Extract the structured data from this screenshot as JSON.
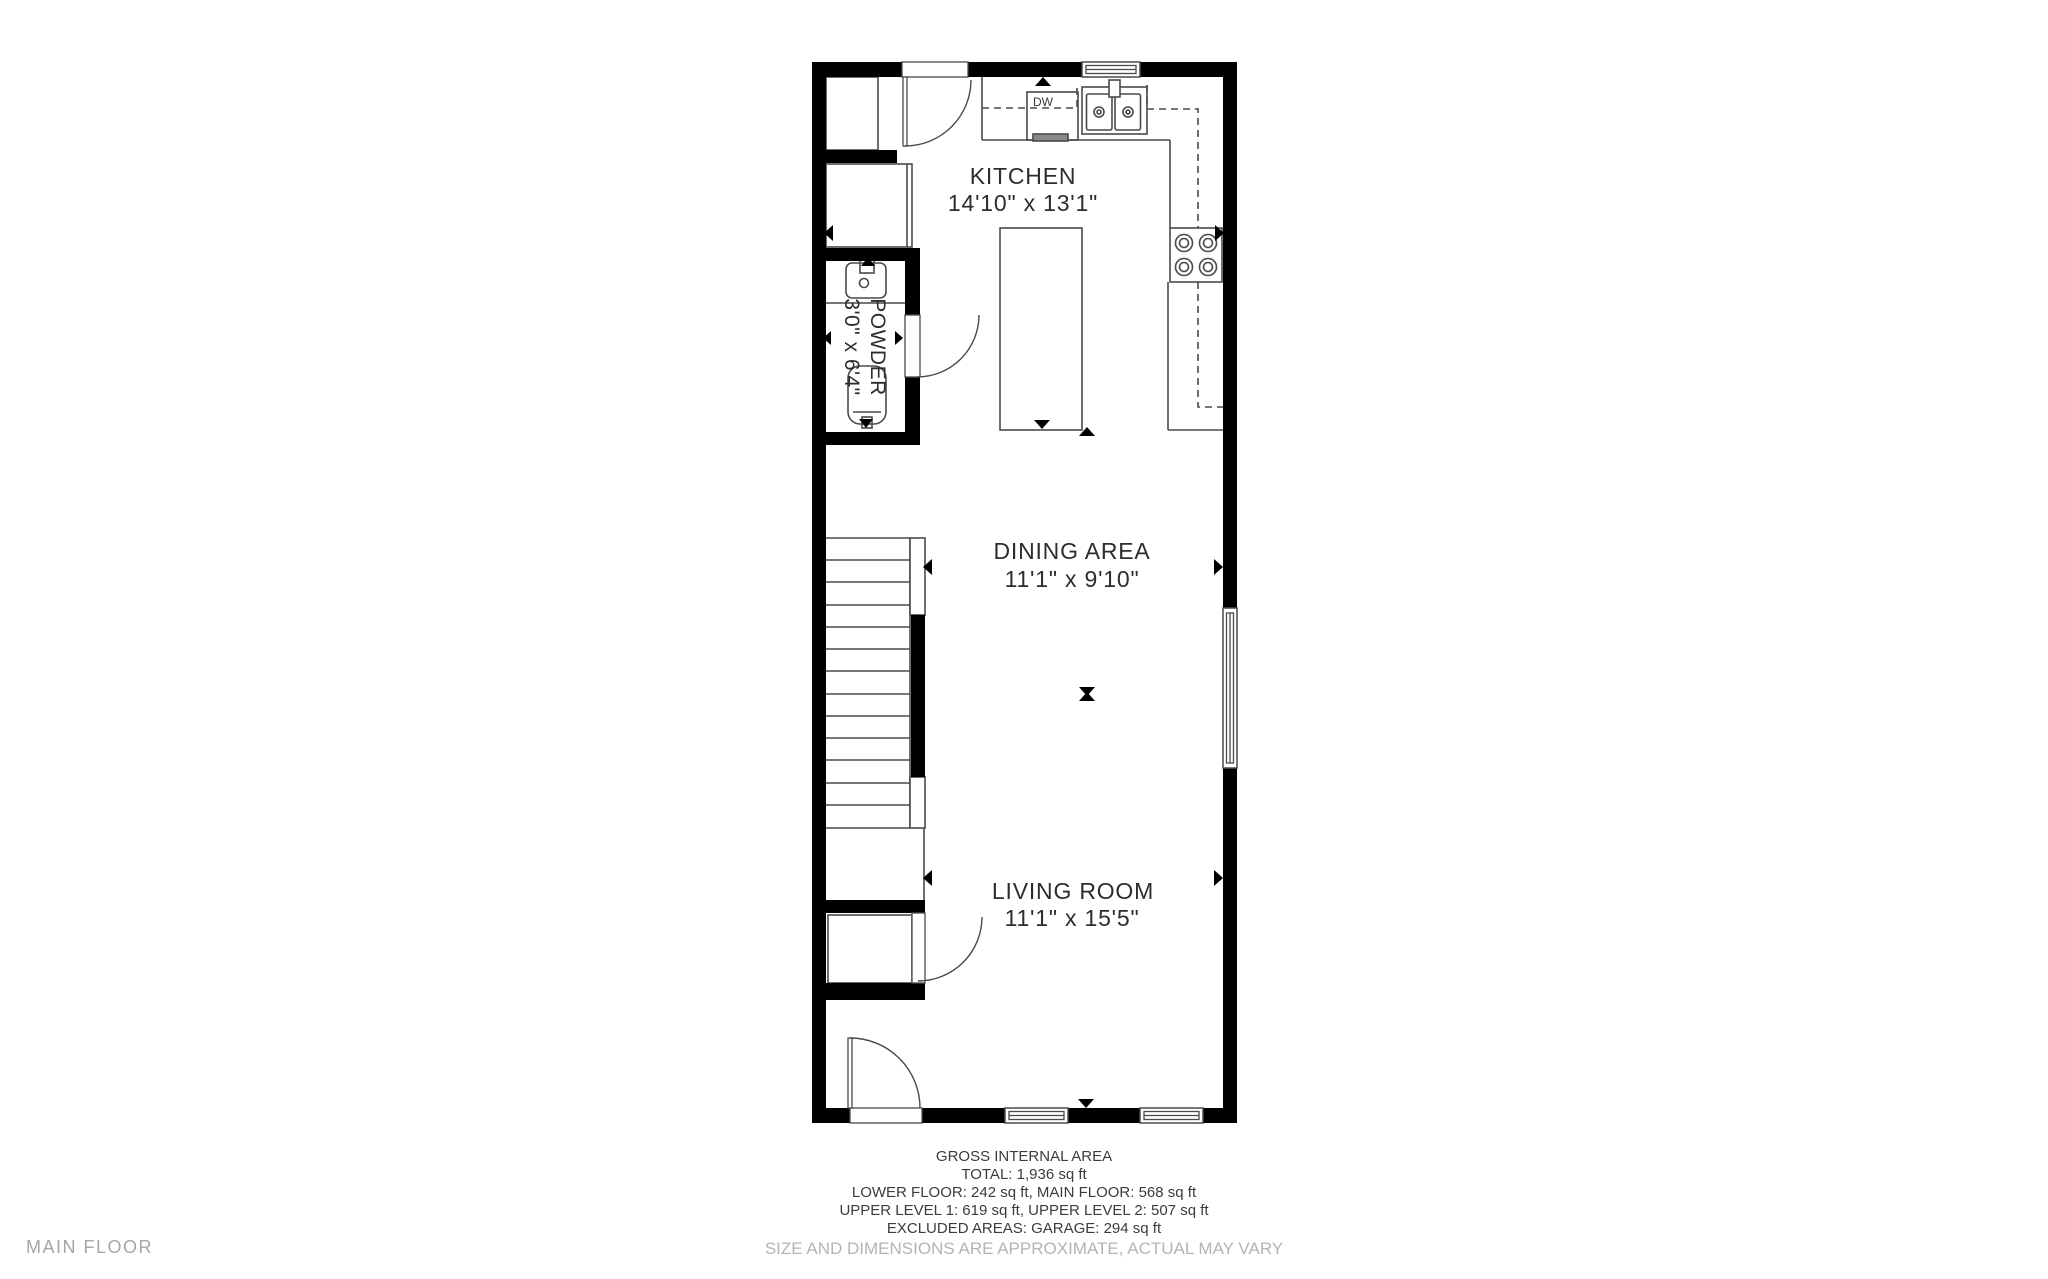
{
  "plan": {
    "floor_label": "MAIN FLOOR",
    "rooms": {
      "kitchen": {
        "name": "KITCHEN",
        "dims": "14'10\" x 13'1\""
      },
      "powder": {
        "name": "POWDER",
        "dims": "3'0\" x 6'4\""
      },
      "dining": {
        "name": "DINING AREA",
        "dims": "11'1\" x 9'10\""
      },
      "living": {
        "name": "LIVING ROOM",
        "dims": "11'1\" x 15'5\""
      }
    },
    "fixtures": {
      "dishwasher": "DW"
    }
  },
  "area_summary": {
    "title": "GROSS INTERNAL AREA",
    "lines": [
      "TOTAL: 1,936 sq ft",
      "LOWER FLOOR: 242 sq ft, MAIN FLOOR: 568 sq ft",
      "UPPER LEVEL 1: 619 sq ft, UPPER LEVEL 2: 507 sq ft",
      "EXCLUDED AREAS: GARAGE: 294 sq ft"
    ],
    "disclaimer": "SIZE AND DIMENSIONS ARE APPROXIMATE, ACTUAL MAY VARY"
  },
  "colors": {
    "wall": "#000000",
    "line": "#4a4a4a",
    "text": "#2d2d2d",
    "muted": "#b4b4b4"
  }
}
